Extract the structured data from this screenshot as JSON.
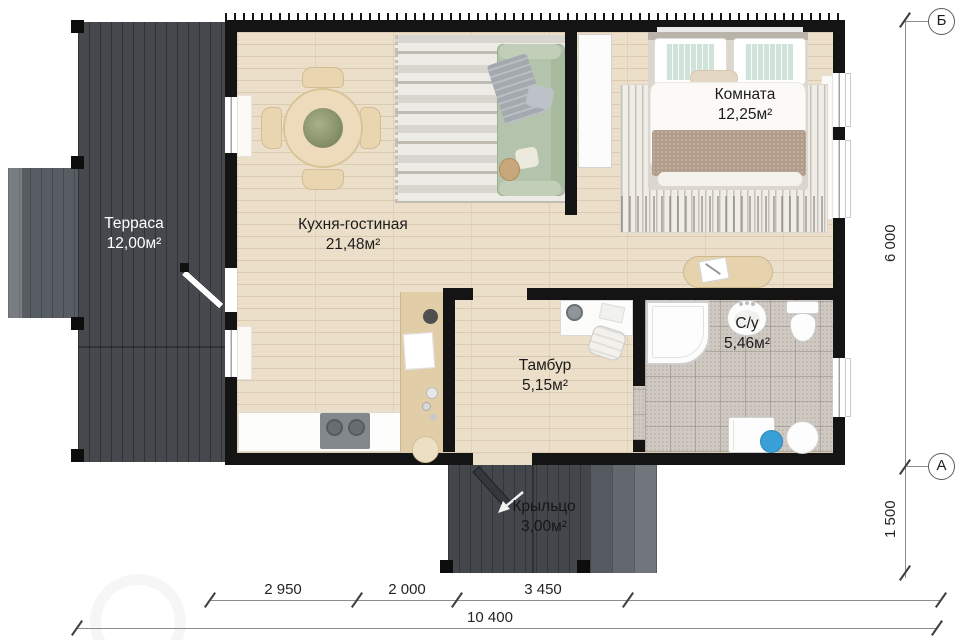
{
  "plan_title": "floor-plan",
  "rooms": [
    {
      "name": "Терраса",
      "area": "12,00м²"
    },
    {
      "name": "Кухня-гостиная",
      "area": "21,48м²"
    },
    {
      "name": "Комната",
      "area": "12,25м²"
    },
    {
      "name": "Тамбур",
      "area": "5,15м²"
    },
    {
      "name": "С/у",
      "area": "5,46м²"
    },
    {
      "name": "Крыльцо",
      "area": "3,00м²"
    }
  ],
  "dimensions": {
    "bottom_segments": [
      "2 950",
      "2 000",
      "3 450"
    ],
    "bottom_total": "10 400",
    "side_height": "6 000",
    "side_porch": "1 500"
  },
  "axes": {
    "top_marker": "Б",
    "bottom_marker": "А"
  },
  "colors": {
    "wall": "#141414",
    "terrace_deck": "#45494e",
    "floor_wood": "#ecdfc9",
    "bath_tile": "#cfc9c2",
    "sofa_sage": "#b4c3ab",
    "stool_blue": "#38a0d6"
  }
}
